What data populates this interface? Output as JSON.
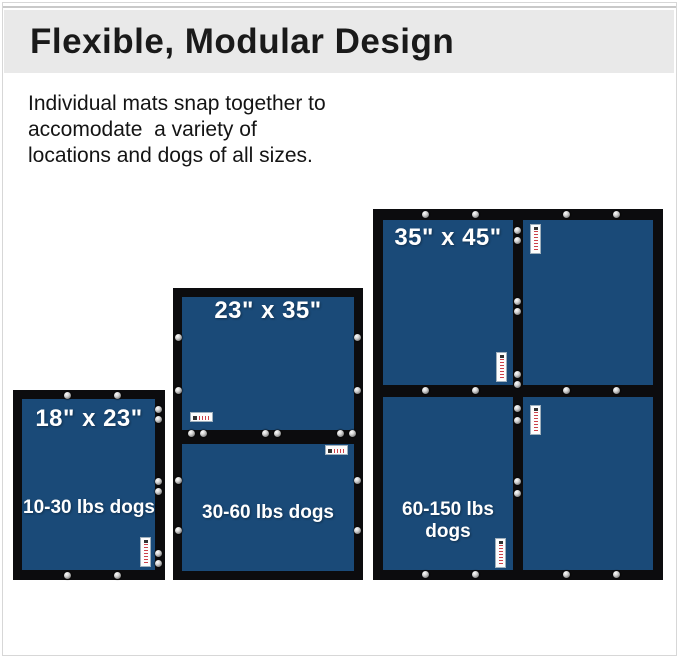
{
  "header": {
    "title": "Flexible, Modular Design"
  },
  "description": {
    "lines": [
      "Individual mats snap together to",
      "accomodate  a variety of",
      "locations and dogs of all sizes."
    ]
  },
  "configs": {
    "small": {
      "size": "18\" x 23\"",
      "weight": "10-30 lbs dogs"
    },
    "medium": {
      "size": "23\" x 35\"",
      "weight": "30-60 lbs dogs"
    },
    "large": {
      "size": "35\" x 45\"",
      "weight": "60-150 lbs dogs"
    }
  },
  "colors": {
    "mat_blue": "#1a4a78",
    "mat_border_black": "#0c0c0e",
    "header_gray": "#e9e9e9",
    "text_black": "#141414",
    "mat_text_white": "#ffffff"
  }
}
